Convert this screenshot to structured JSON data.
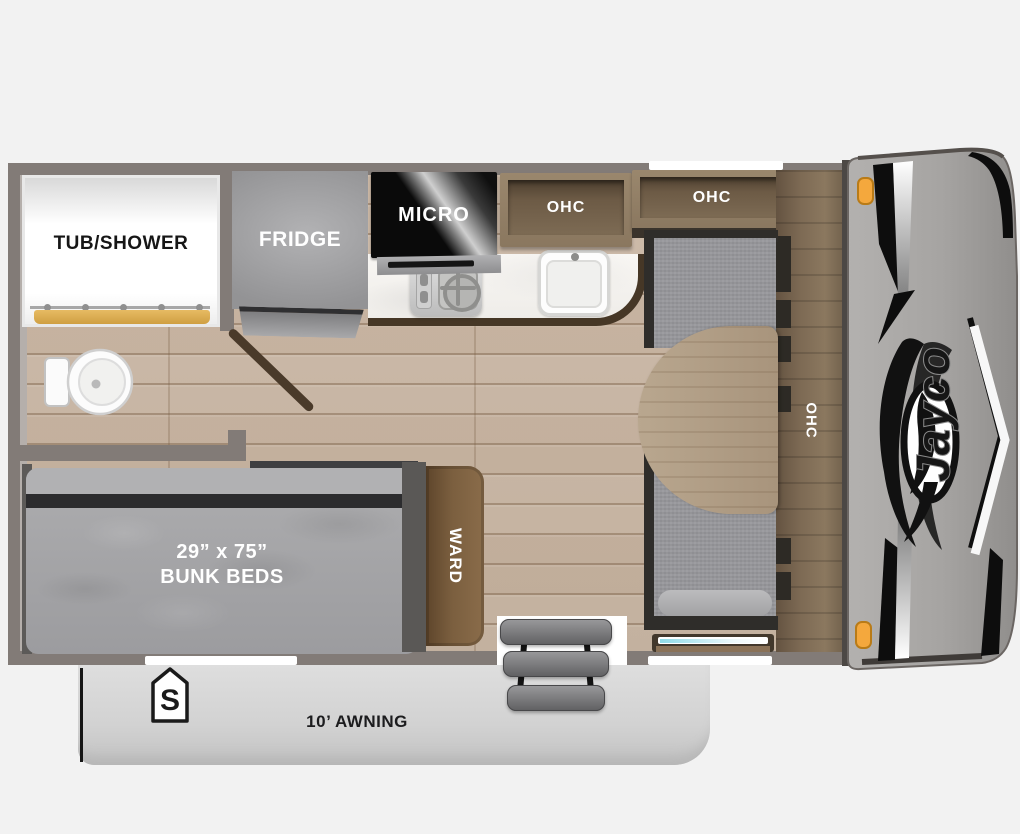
{
  "floorplan": {
    "labels": {
      "tub_shower": "TUB/SHOWER",
      "fridge": "FRIDGE",
      "micro": "MICRO",
      "ohc_kitchen": "OHC",
      "ohc_front": "OHC",
      "ohc_side": "OHC",
      "bunk_size": "29” x 75”",
      "bunk_name": "BUNK BEDS",
      "ward": "WARD",
      "awning": "10’ AWNING",
      "spare_badge": "S",
      "brand": "Jayco"
    },
    "colors": {
      "background": "#f2f2f2",
      "wall": "#827b77",
      "floor_wood": "#c9b7a5",
      "cabinet_wood": "#7d6a54",
      "dark_wood_trim": "#4a3a2a",
      "counter": "#f8f6f3",
      "cushion_gray": "#98989c",
      "mattress_gray": "#a4a4a6",
      "curtain_gold": "#d8a94e",
      "front_cap_gray": "#a7a5a3",
      "marker_light_orange": "#f4a83d",
      "window_teal": "#8fdbe7",
      "awning_gray": "#d6d6d6"
    }
  }
}
